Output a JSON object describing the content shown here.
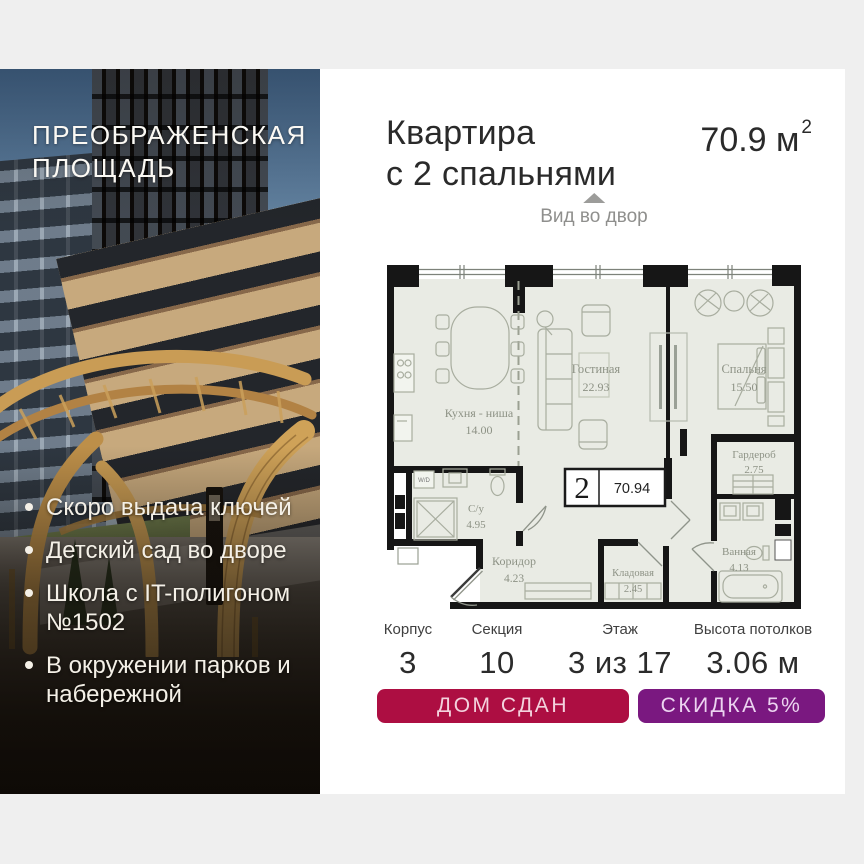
{
  "project": {
    "name_line1": "ПРЕОБРАЖЕНСКАЯ",
    "name_line2": "ПЛОЩАДЬ",
    "bullets": [
      "Скоро выдача ключей",
      "Детский сад во дворе",
      "Школа с IT-полигоном №1502",
      "В окружении парков и набережной"
    ]
  },
  "apartment": {
    "title_line1": "Квартира",
    "title_line2": "с 2 спальнями",
    "area_value": "70.9",
    "area_unit": "м",
    "area_sup": "2",
    "view_label": "Вид во двор"
  },
  "floorplan": {
    "badge_rooms": "2",
    "badge_area": "70.94",
    "washer_label": "W/D",
    "rooms": [
      {
        "name": "Кухня - ниша",
        "area": "14.00"
      },
      {
        "name": "Гостиная",
        "area": "22.93"
      },
      {
        "name": "Спальня",
        "area": "15.50"
      },
      {
        "name": "Гардероб",
        "area": "2.75"
      },
      {
        "name": "С/у",
        "area": "4.95"
      },
      {
        "name": "Коридор",
        "area": "4.23"
      },
      {
        "name": "Кладовая",
        "area": "2.45"
      },
      {
        "name": "Ванная",
        "area": "4.13"
      }
    ]
  },
  "stats": [
    {
      "label": "Корпус",
      "value": "3"
    },
    {
      "label": "Секция",
      "value": "10"
    },
    {
      "label": "Этаж",
      "value": "3 из 17"
    },
    {
      "label": "Высота потолков",
      "value": "3.06 м"
    }
  ],
  "badges": [
    {
      "label": "ДОМ СДАН",
      "color": "#ad0e42"
    },
    {
      "label": "СКИДКА 5%",
      "color": "#7a1880"
    }
  ]
}
